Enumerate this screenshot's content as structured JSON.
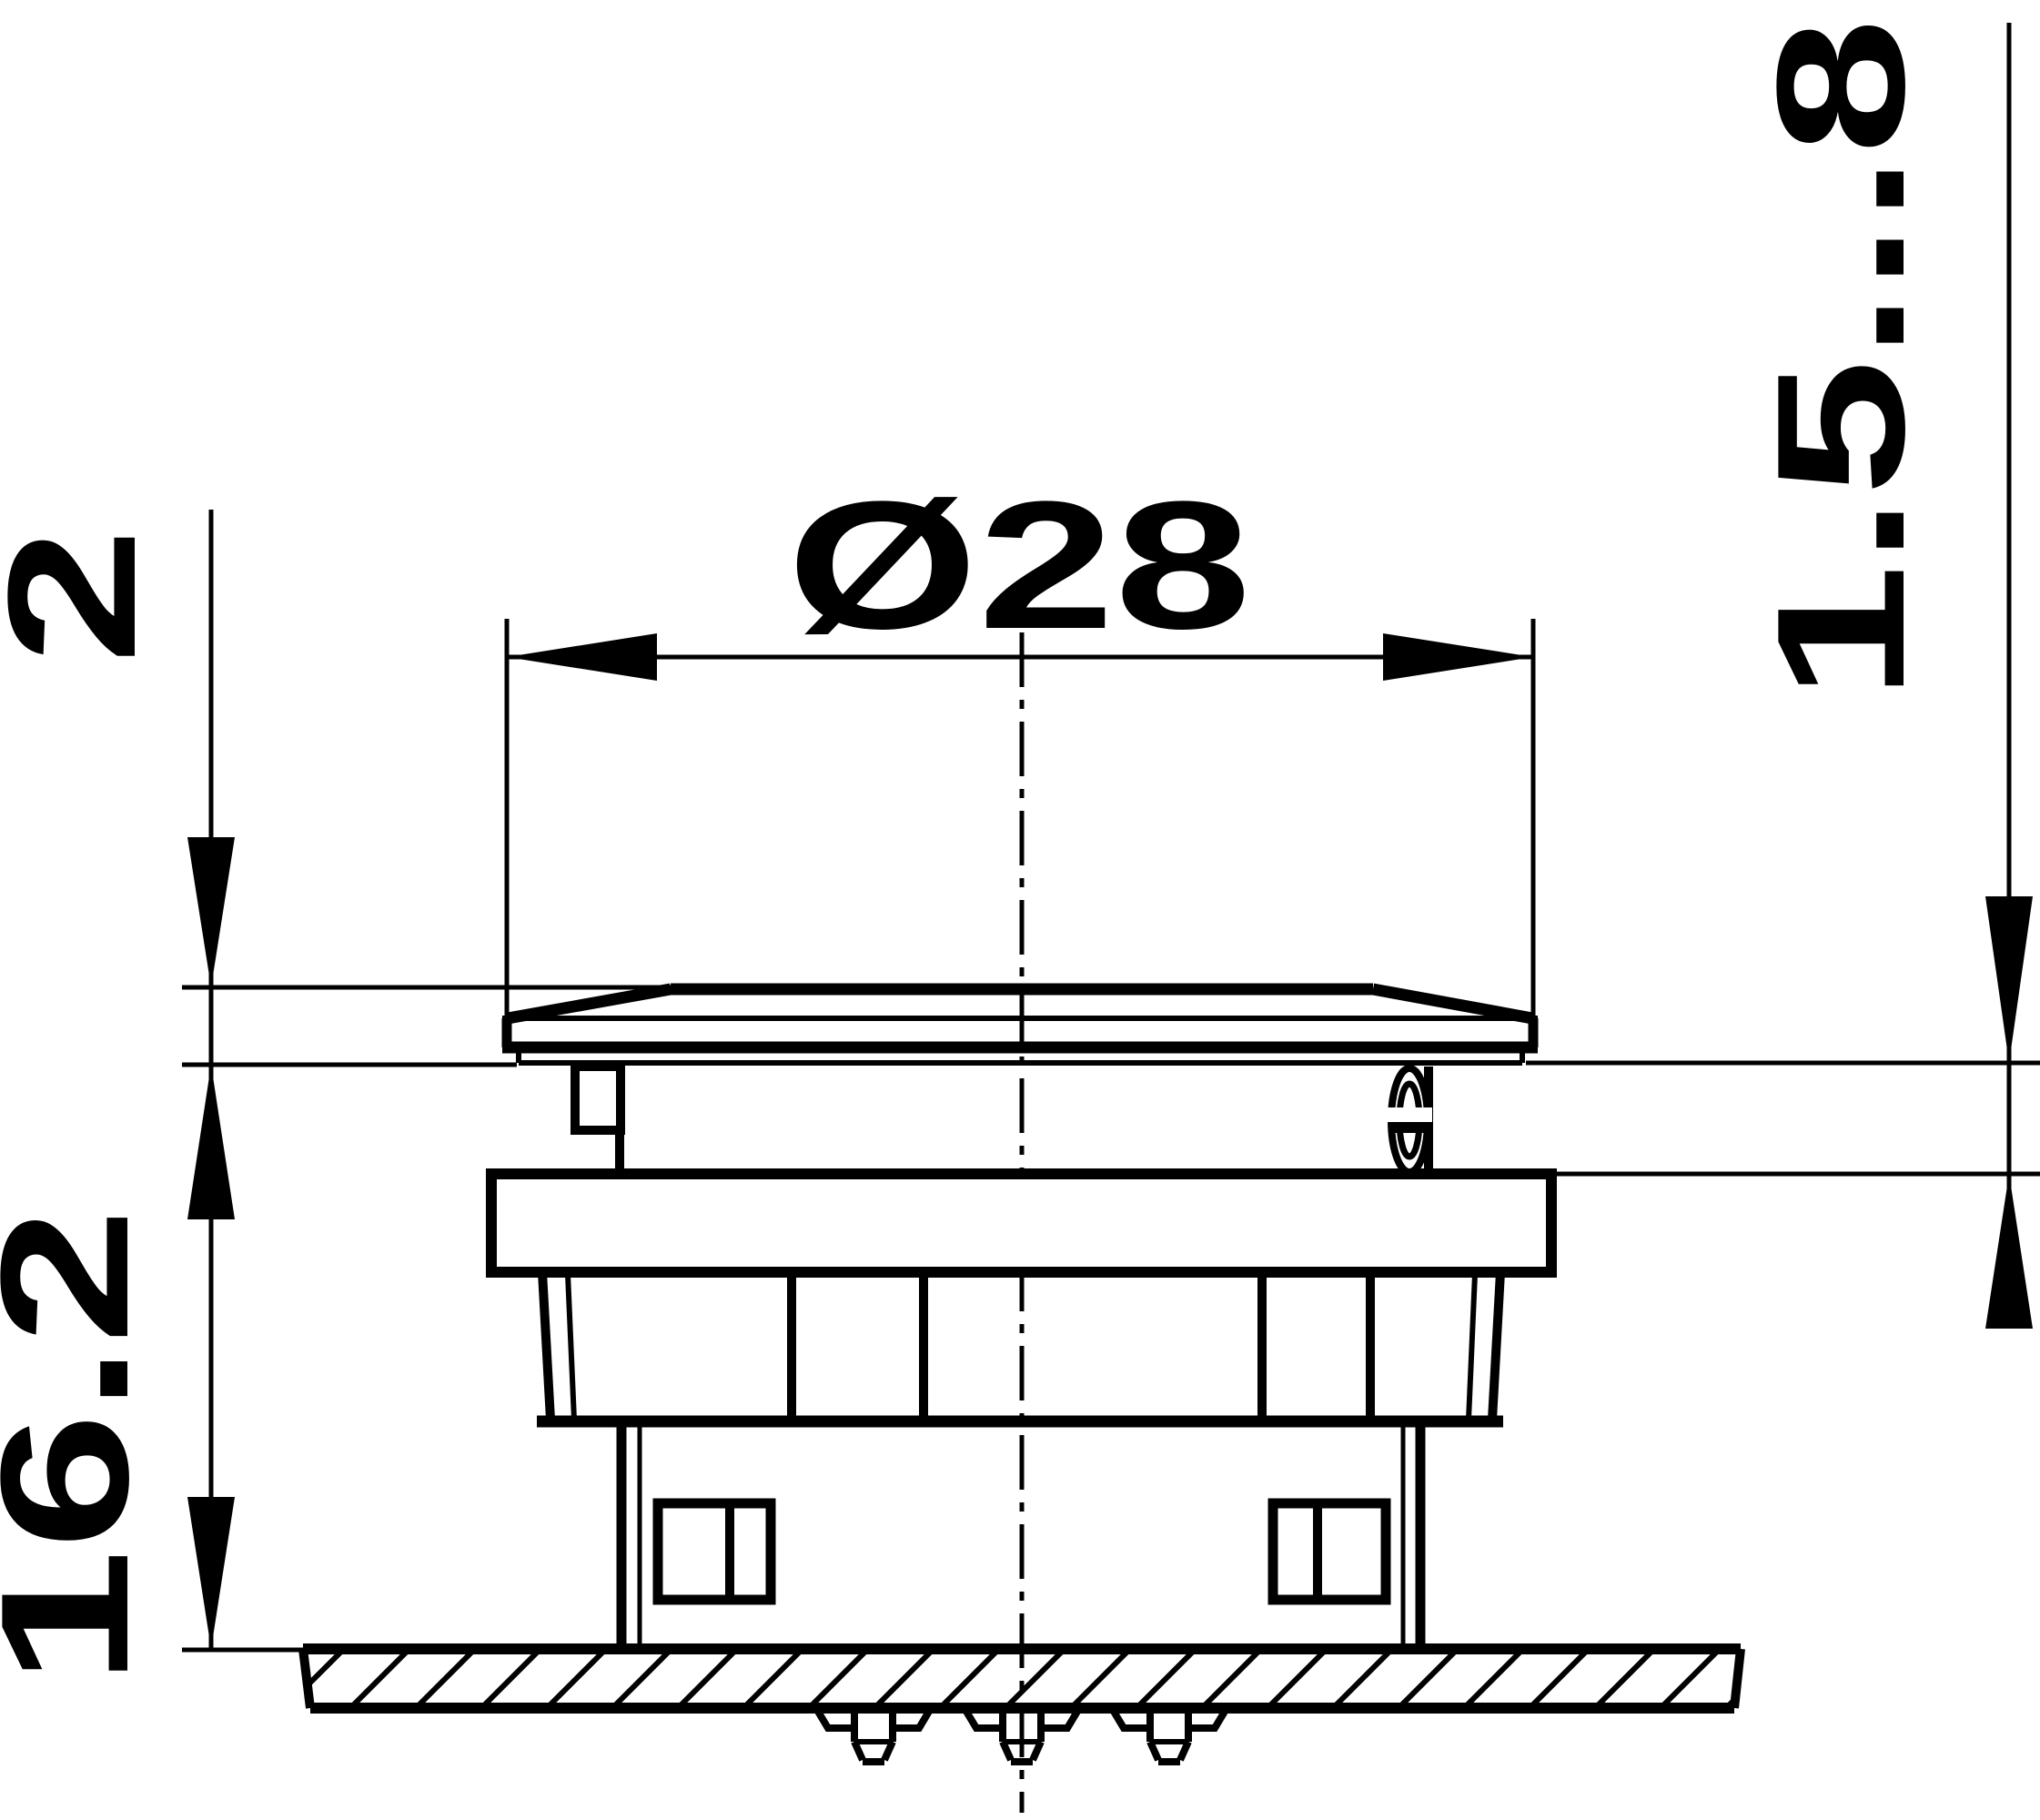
{
  "drawing": {
    "type": "engineering-dimension-drawing",
    "view": "side-elevation-of-panel-mounted-pushbutton",
    "labels": {
      "diameter": "Ø28",
      "cap_height": "2",
      "height_above_panel": "16.2",
      "travel": "1.5...8"
    },
    "colors": {
      "line": "#000000",
      "background": "#ffffff"
    }
  }
}
